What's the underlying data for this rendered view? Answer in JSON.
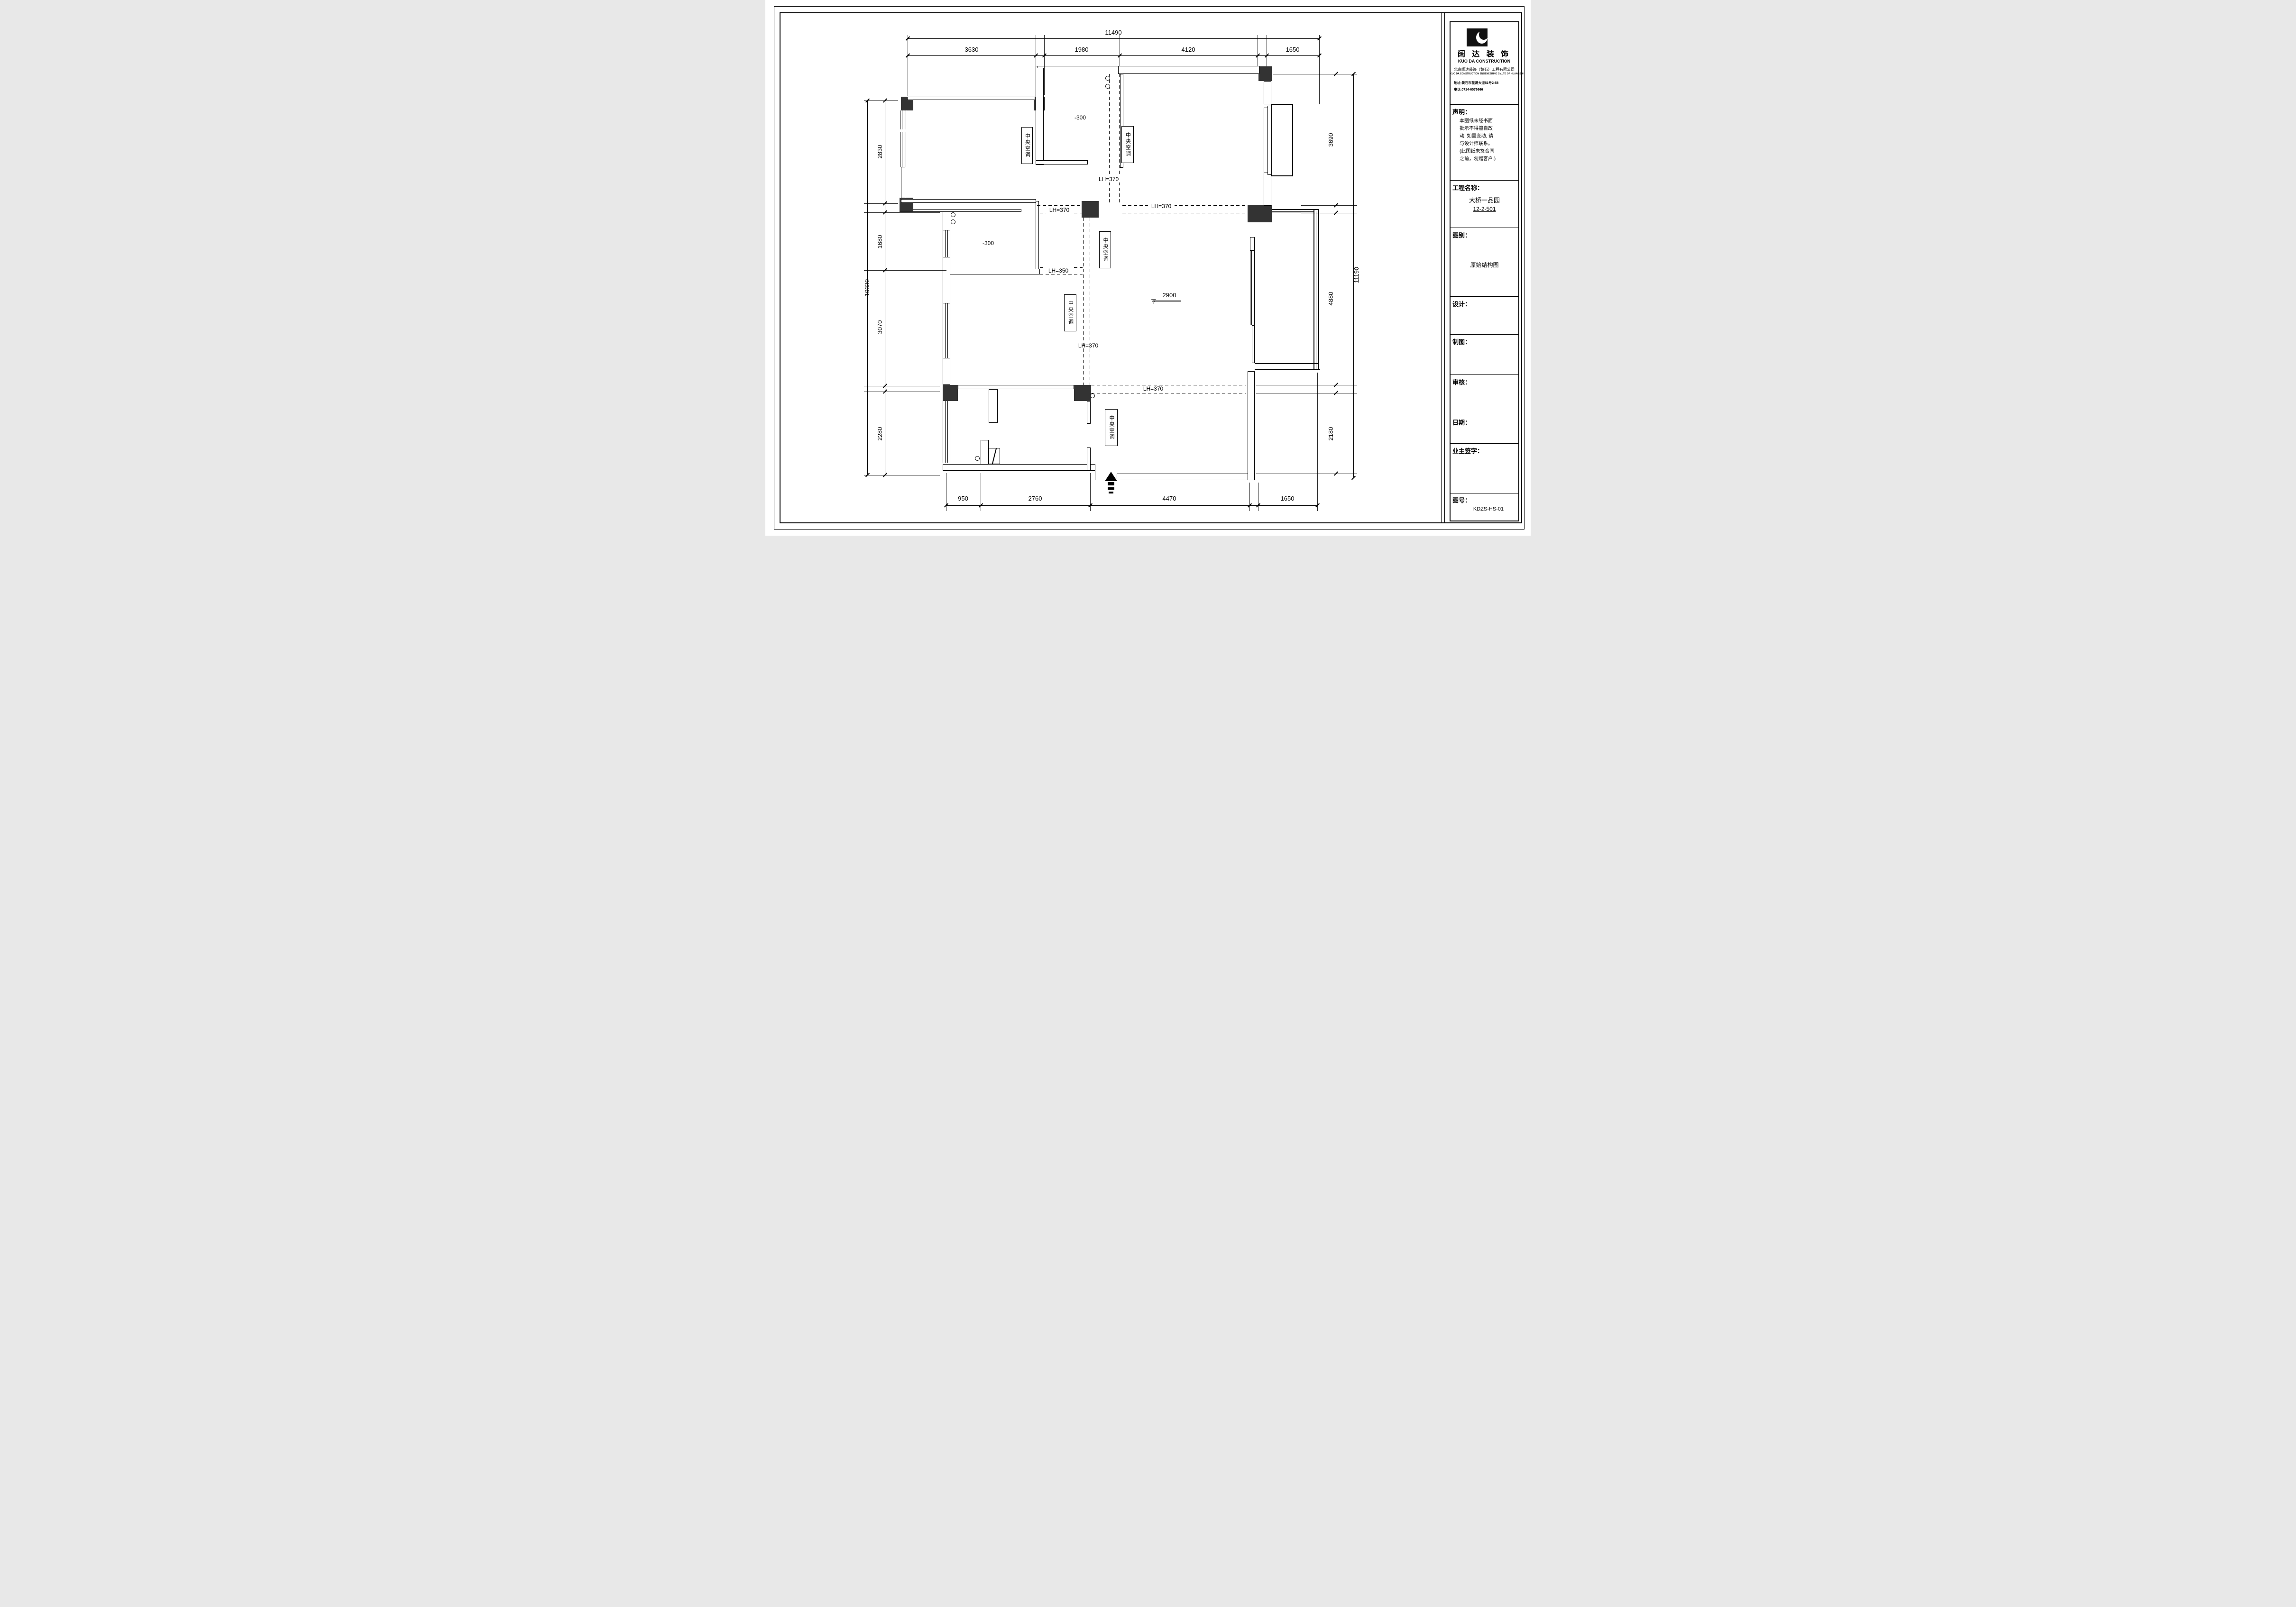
{
  "title_block": {
    "company_cn": "阔 达 装 饰",
    "company_en": "KUO DA CONSTRUCTION",
    "company_full_cn": "北京阔达装饰（黄石）工程有限公司",
    "company_full_en": "KUO DA CONSTRUCTION ENGENEERING Co.LTD OF HUANGSHI",
    "address": "地址:黄石市花湖大道51号2-58",
    "phone": "电话:0714-6576666",
    "statement_label": "声明：",
    "statement_text": "本图纸未经书面\n批示不得擅自改\n动. 如需变动, 请\n与设计师联系。\n(此图纸未签合同\n之前，勿赠客户.)",
    "project_label": "工程名称：",
    "project_name": "大桥一品园",
    "project_no": "12-2-501",
    "drawing_type_label": "图别：",
    "drawing_type": "原始结构图",
    "designer_label": "设计：",
    "drafter_label": "制图：",
    "checker_label": "审核：",
    "date_label": "日期：",
    "owner_sign_label": "业主签字：",
    "drawing_no_label": "图号：",
    "drawing_no": "KDZS-HS-01"
  },
  "plan": {
    "ac_labels": [
      "中央空调",
      "中央空调",
      "中央空调",
      "中央空调",
      "中央空调"
    ],
    "lh_labels": [
      "LH=370",
      "LH=370",
      "LH=370",
      "LH=350",
      "LH=370",
      "LH=370"
    ],
    "level_labels": [
      "-300",
      "-300"
    ],
    "ceiling_height": "2900",
    "dimensions": {
      "top": {
        "overall": "11490",
        "segments": [
          "3630",
          "1980",
          "4120",
          "1650"
        ]
      },
      "bottom": {
        "segments": [
          "950",
          "2760",
          "4470",
          "1650"
        ]
      },
      "left": {
        "overall": "10330",
        "segments": [
          "2830",
          "1680",
          "3070",
          "2280"
        ]
      },
      "right": {
        "overall": "11190",
        "segments": [
          "3690",
          "4880",
          "2180"
        ]
      }
    }
  }
}
